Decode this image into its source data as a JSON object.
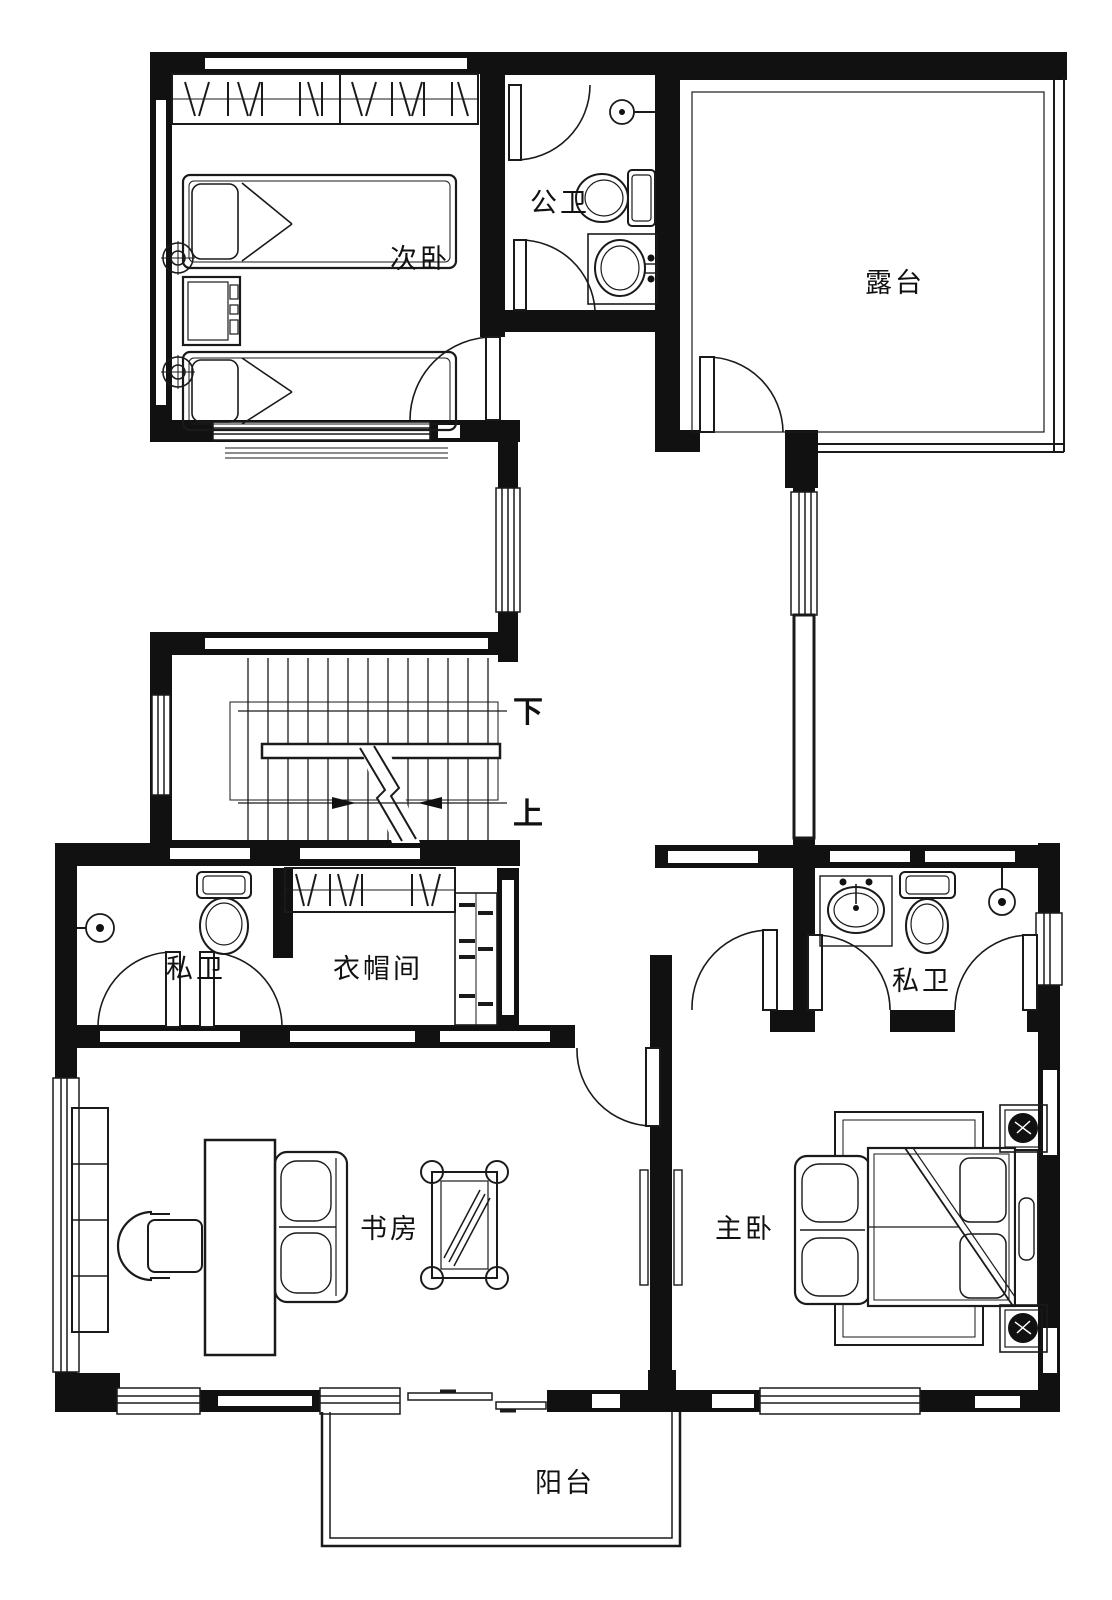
{
  "rooms": {
    "secondary_bedroom": {
      "label": "次卧"
    },
    "public_bathroom": {
      "label": "公卫"
    },
    "terrace": {
      "label": "露台"
    },
    "private_bathroom_left": {
      "label": "私卫"
    },
    "cloakroom": {
      "label": "衣帽间"
    },
    "private_bathroom_right": {
      "label": "私卫"
    },
    "study": {
      "label": "书房"
    },
    "master_bedroom": {
      "label": "主卧"
    },
    "balcony": {
      "label": "阳台"
    }
  },
  "stairs": {
    "down_label": "下",
    "up_label": "上"
  },
  "colors": {
    "wall": "#111111",
    "line": "#1a1a1a",
    "background": "#ffffff"
  },
  "fixtures": {
    "secondary_bedroom": [
      "wardrobe",
      "single-bed",
      "single-bed",
      "nightstand",
      "wall-lamp",
      "wall-lamp"
    ],
    "public_bathroom": [
      "shower-head",
      "toilet",
      "sink"
    ],
    "private_bathroom_left": [
      "shower-head",
      "toilet"
    ],
    "private_bathroom_right": [
      "sink",
      "toilet",
      "shower-head"
    ],
    "cloakroom": [
      "wardrobe",
      "shelves"
    ],
    "study": [
      "bookshelf",
      "desk",
      "office-chair",
      "sofa",
      "table"
    ],
    "master_bedroom": [
      "rug",
      "loveseat",
      "double-bed",
      "headboard-bench",
      "plant",
      "plant"
    ]
  }
}
